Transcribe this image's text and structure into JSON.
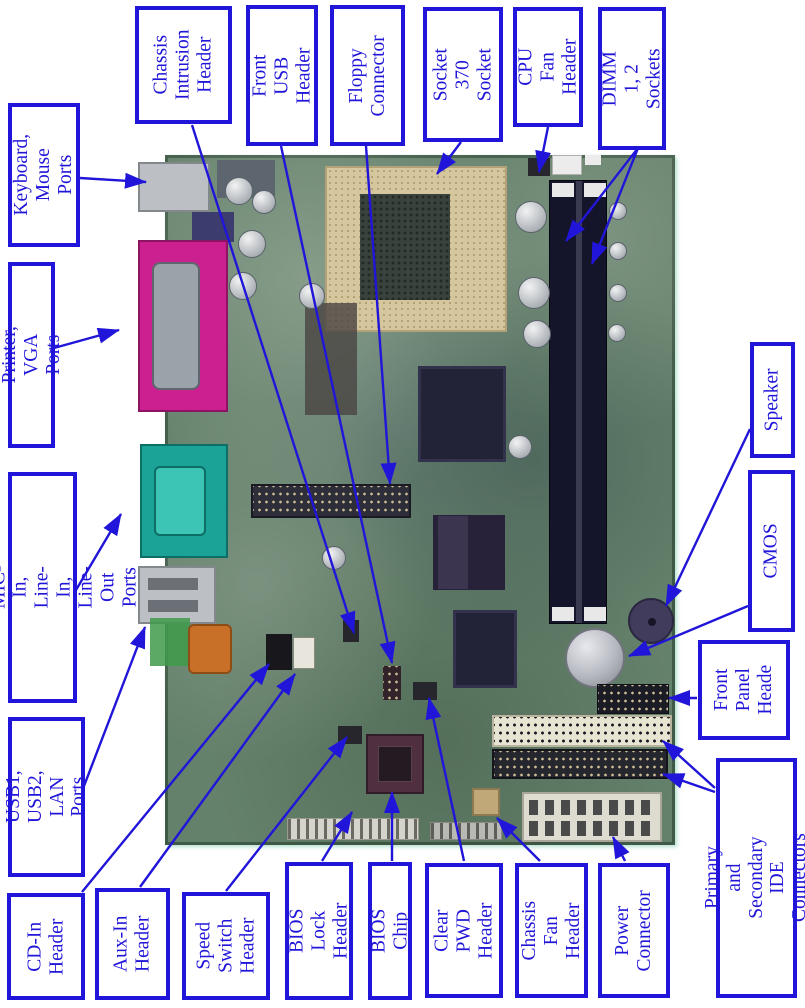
{
  "figure_type": "motherboard callout diagram",
  "colors": {
    "label_blue": "#2015d8",
    "board_green": "#64816b",
    "socket_beige": "#d6c69e",
    "printer_magenta": "#cc2090",
    "com_teal": "#1aa396",
    "port_grey": "#bcc0c4",
    "dimm_black": "#14142a",
    "chip_navy": "#232338",
    "ide_beige": "#e8e4d2",
    "battery_silver": "#b6b8c0",
    "speaker_purple": "#423c5c",
    "orange_part": "#c87028",
    "power_white": "#dedcd0",
    "bios_maroon": "#503040"
  },
  "labels": [
    {
      "id": "chassis-intrusion-header",
      "text": "Chassis\nIntrusion\nHeader",
      "target": "chassis intrusion header on board"
    },
    {
      "id": "front-usb-header",
      "text": "Front USB\nHeader",
      "target": "front USB header on board"
    },
    {
      "id": "floppy-connector",
      "text": "Floppy\nConnector",
      "target": "floppy connector on board"
    },
    {
      "id": "socket-370-socket",
      "text": "Socket 370\nSocket",
      "target": "CPU socket"
    },
    {
      "id": "cpu-fan-header",
      "text": "CPU Fan\nHeader",
      "target": "CPU fan header"
    },
    {
      "id": "dimm-1-2-sockets",
      "text": "DIMM 1, 2\nSockets",
      "target": "DIMM memory slots"
    },
    {
      "id": "keyboard-mouse-ports",
      "text": "Keyboard,\nMouse Ports",
      "target": "PS/2 port stack"
    },
    {
      "id": "printer-vga-ports",
      "text": "Printer, VGA Ports",
      "target": "parallel/VGA connector"
    },
    {
      "id": "com1-audio-ports",
      "text": "COM 1, MIC-In, Line-\nIn, Line-Out Ports",
      "target": "serial and audio ports"
    },
    {
      "id": "usb1-usb2-lan-ports",
      "text": "USB1, USB2,\nLAN Ports",
      "target": "USB/LAN port stack"
    },
    {
      "id": "speaker",
      "text": "Speaker",
      "target": "piezo speaker"
    },
    {
      "id": "cmos",
      "text": "CMOS",
      "target": "CMOS coin-cell battery"
    },
    {
      "id": "front-panel-header",
      "text": "Front\nPanel\nHeade",
      "target": "front panel header"
    },
    {
      "id": "primary-secondary-ide",
      "text": "Primary and Secondary\nIDE Connectors",
      "target": "two IDE connectors"
    },
    {
      "id": "cd-in-header",
      "text": "CD-In\nHeader",
      "target": "CD audio-in header"
    },
    {
      "id": "aux-in-header",
      "text": "Aux-In\nHeader",
      "target": "aux audio-in header"
    },
    {
      "id": "speed-switch-header",
      "text": "Speed\nSwitch\nHeader",
      "target": "speed switch header"
    },
    {
      "id": "bios-lock-header",
      "text": "BIOS Lock\nHeader",
      "target": "BIOS lock header"
    },
    {
      "id": "bios-chip",
      "text": "BIOS Chip",
      "target": "BIOS chip in socket"
    },
    {
      "id": "clear-pwd-header",
      "text": "Clear PWD\nHeader",
      "target": "clear password header"
    },
    {
      "id": "chassis-fan-header",
      "text": "Chassis\nFan Header",
      "target": "chassis fan header"
    },
    {
      "id": "power-connector",
      "text": "Power\nConnector",
      "target": "ATX power connector"
    }
  ]
}
